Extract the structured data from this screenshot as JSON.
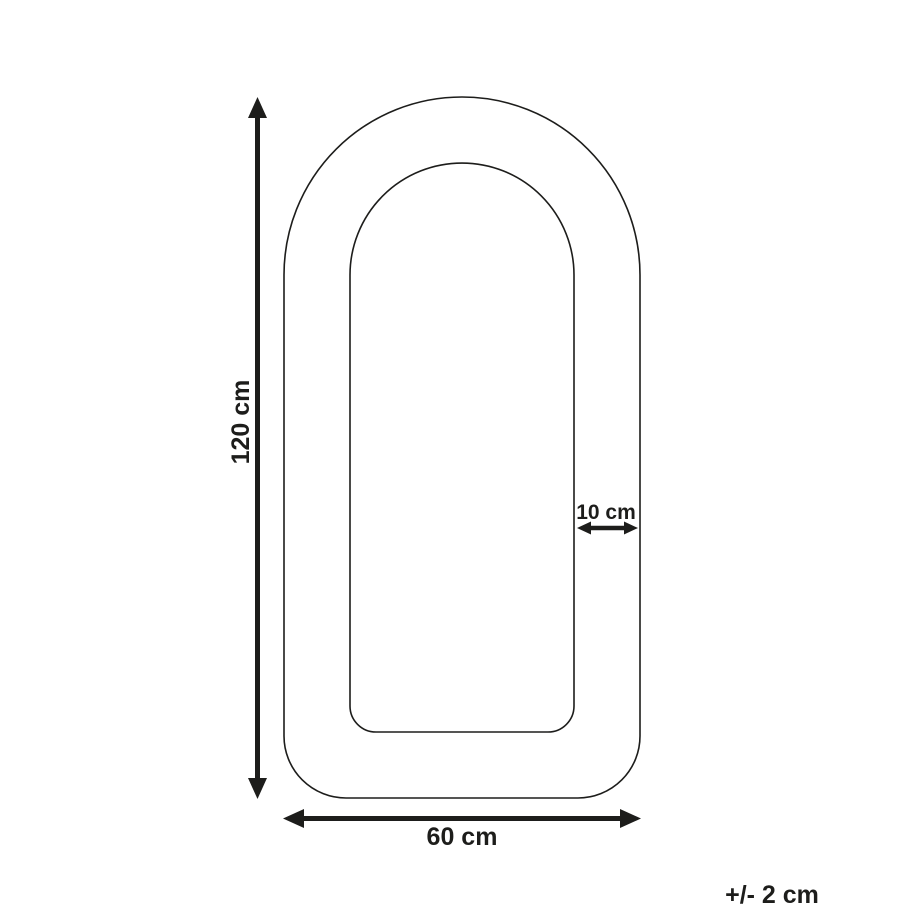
{
  "diagram": {
    "background_color": "#ffffff",
    "line_color": "#1d1d1b",
    "dimensions": {
      "height": {
        "label": "120 cm"
      },
      "width": {
        "label": "60 cm"
      },
      "border": {
        "label": "10 cm"
      }
    },
    "tolerance": {
      "label": "+/- 2 cm"
    }
  }
}
